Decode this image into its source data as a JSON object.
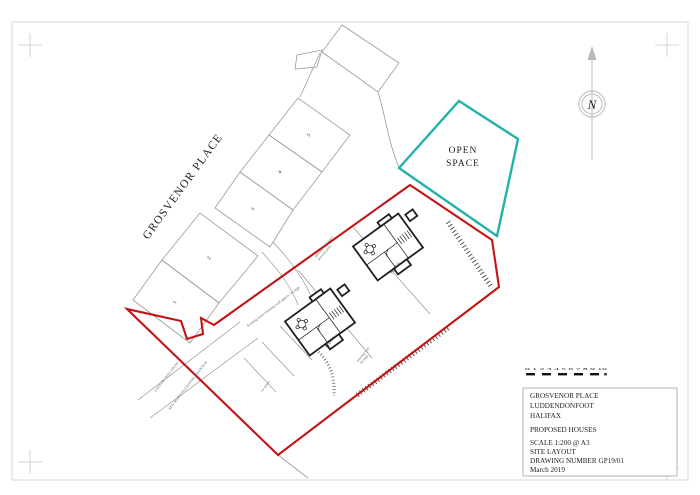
{
  "colors": {
    "boundary_red": "#c21414",
    "open_space_teal": "#22b2aa",
    "context_gray": "#9a9a9a",
    "building_dark": "#1f1f1f",
    "frame_gray": "#d7d7d7",
    "text_dark": "#1c1c1c"
  },
  "street": {
    "label": "GROSVENOR PLACE"
  },
  "existing_plots": {
    "numbers": [
      "1",
      "2",
      "3",
      "4",
      "5"
    ]
  },
  "open_space": {
    "line1": "OPEN",
    "line2": "SPACE"
  },
  "proposed": {
    "plot1": "PLOT 1",
    "plot2": "PLOT 2",
    "car_spaces": "car spaces"
  },
  "annotations": {
    "retaining_wall": "Existing stone retaining wall approx 1m high",
    "fence_upper_line1": "1800mm high fence",
    "fence_upper_line2": "between plots",
    "fence_lower_line1": "Existing wall",
    "fence_lower_line2": "1m high",
    "foul_drain": "EXISTING FOUL DRAIN",
    "new_mains": "NEW MAINS TO EXISTING DRAIN RUN"
  },
  "north": {
    "letter": "N"
  },
  "scale_bar": {
    "ticks_text": "0 1 2 3 4 5 6 7 8 9 10"
  },
  "title_block": {
    "project_line1": "GROSVENOR PLACE",
    "project_line2": "LUDDENDONFOOT",
    "project_line3": "HALIFAX",
    "description": "PROPOSED HOUSES",
    "scale": "SCALE 1:200 @ A3",
    "drawing_title": "SITE LAYOUT",
    "drawing_number": "DRAWING NUMBER GP19/01",
    "date": "March 2019"
  }
}
